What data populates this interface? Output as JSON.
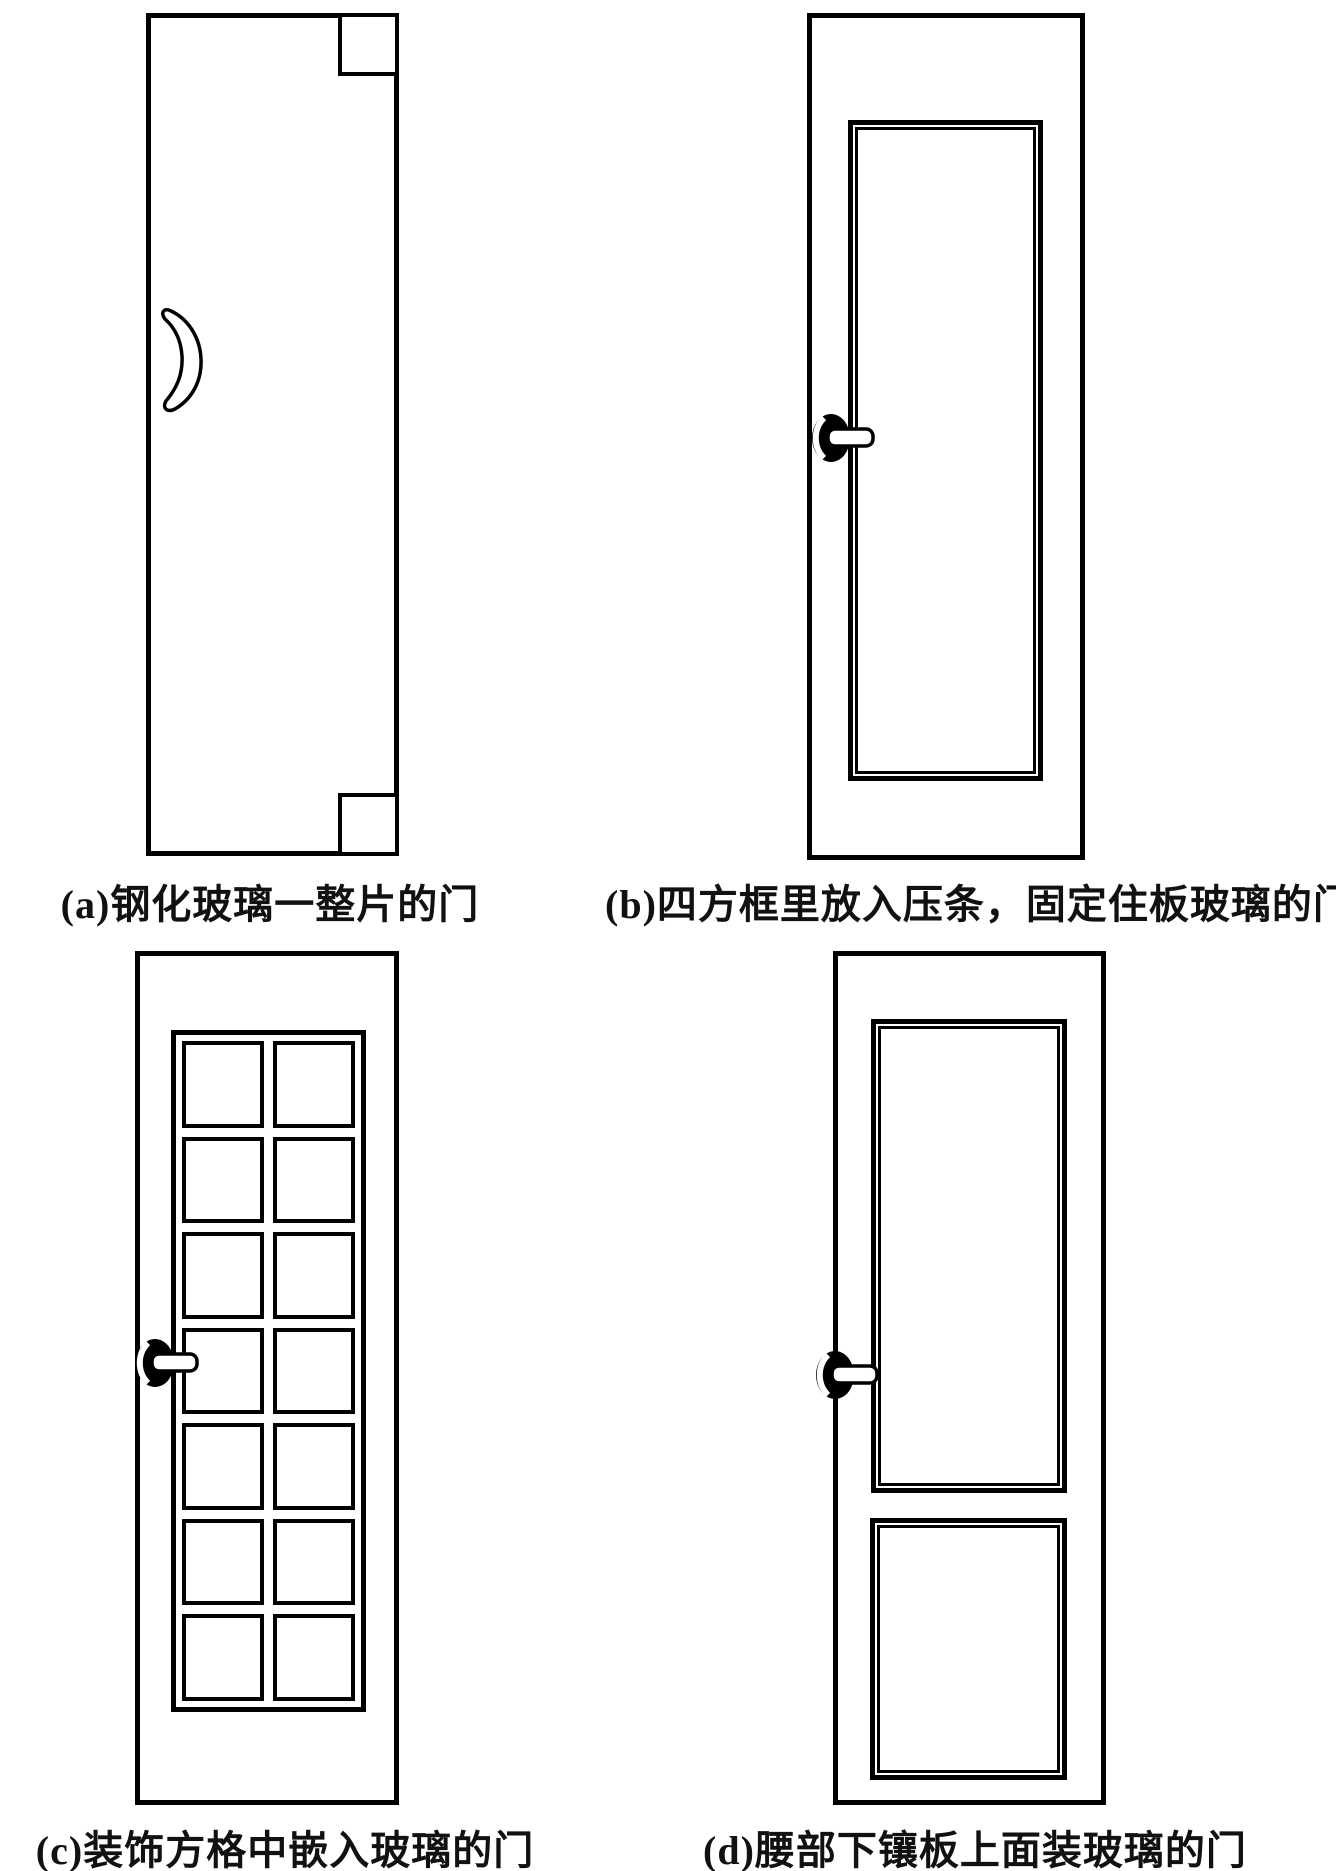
{
  "palette": {
    "line_color": "#000000",
    "background": "#ffffff",
    "text_color": "#111111"
  },
  "figures": [
    {
      "label": "a",
      "caption": "(a)钢化玻璃一整片的门"
    },
    {
      "label": "b",
      "caption": "(b)四方框里放入压条，固定住板玻璃的门"
    },
    {
      "label": "c",
      "caption": "(c)装饰方格中嵌入玻璃的门"
    },
    {
      "label": "d",
      "caption": "(d)腰部下镶板上面装玻璃的门"
    }
  ]
}
